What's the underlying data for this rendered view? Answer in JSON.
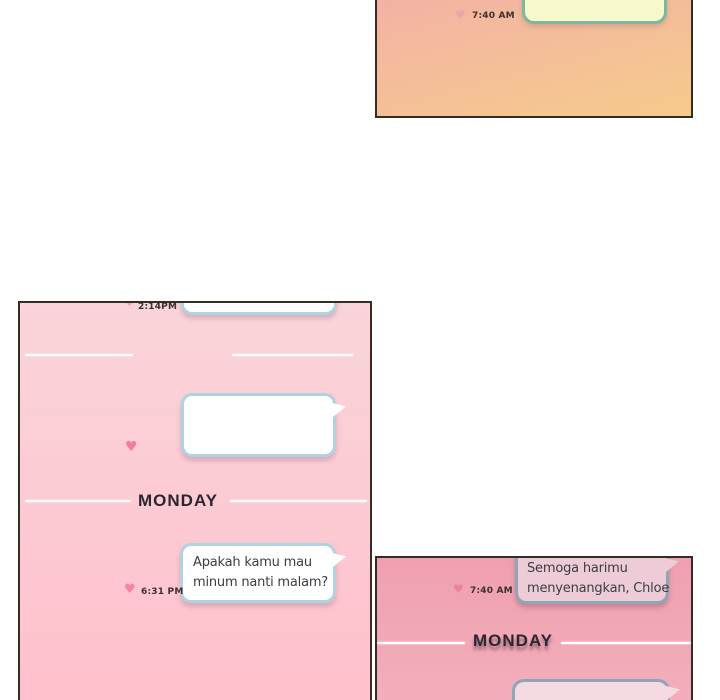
{
  "glyphs": {
    "heart": "♥"
  },
  "colors": {
    "panel_border": "#332d24",
    "morning_bg_top": "#f3b2a5",
    "morning_bg_bottom": "#f6cb8c",
    "afternoon_bg_top": "#fad4da",
    "afternoon_bg_bottom": "#ffc1cc",
    "evening_bg_top": "#efa0b0",
    "evening_bg_bottom": "#f4aebb",
    "yellow_bubble_fill": "#f8f8cd",
    "yellow_bubble_border": "#7cb7a6",
    "white_bubble_border": "#b0d3e4",
    "pink_bubble_fill": "#edccd7",
    "pink_bubble_border": "#8ea6b8",
    "pink_bubble2_fill": "#f6dae1"
  },
  "panel_morning": {
    "timestamp": "7:40 AM"
  },
  "panel_afternoon": {
    "timestamp_top": "2:14PM",
    "day_divider": "MONDAY",
    "message": {
      "line1": "Apakah kamu mau",
      "line2": "minum nanti malam?"
    },
    "timestamp_bottom": "6:31 PM"
  },
  "panel_evening": {
    "message": {
      "line1": "Semoga harimu",
      "line2": "menyenangkan, Chloe"
    },
    "timestamp": "7:40 AM",
    "day_divider": "MONDAY"
  }
}
